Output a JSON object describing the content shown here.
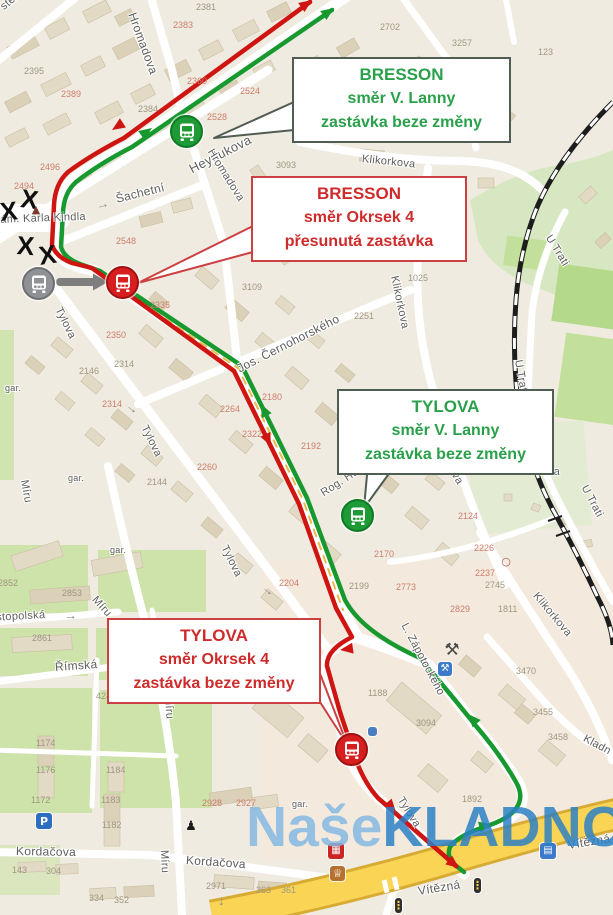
{
  "watermark": {
    "light": "Naše",
    "dark": "KLADNO"
  },
  "callouts": [
    {
      "title": "BRESSON",
      "line1": "směr V. Lanny",
      "line2": "zastávka beze změny",
      "variant": "green"
    },
    {
      "title": "BRESSON",
      "line1": "směr Okrsek 4",
      "line2": "přesunutá zastávka",
      "variant": "red"
    },
    {
      "title": "TYLOVA",
      "line1": "směr V. Lanny",
      "line2": "zastávka beze změny",
      "variant": "green"
    },
    {
      "title": "TYLOVA",
      "line1": "směr Okrsek 4",
      "line2": "zastávka beze změny",
      "variant": "red"
    }
  ],
  "colors": {
    "route_green": "#18992f",
    "route_red": "#cf1512",
    "callout_green_text": "#2aa04b",
    "callout_red_text": "#ce2b2b",
    "road_yellow": "#f9d455",
    "watermark_light": "#85b8e3",
    "watermark_dark": "#2a80c6",
    "stop_green": "#1e9a36",
    "stop_red": "#d81f1f",
    "stop_gray": "#8f9194"
  },
  "map": {
    "street_labels": [
      {
        "t": "sterova",
        "x": 2,
        "y": 2,
        "r": -40
      },
      {
        "t": "Heydukova",
        "x": 190,
        "y": 162,
        "r": -27,
        "s": 13
      },
      {
        "t": "Hromadova",
        "x": 132,
        "y": 6,
        "r": 70,
        "s": 12
      },
      {
        "t": "Hromadova",
        "x": 210,
        "y": 144,
        "r": 58
      },
      {
        "t": "Šachetní",
        "x": 116,
        "y": 192,
        "r": -14,
        "s": 12
      },
      {
        "t": "nám. Karla Kindla",
        "x": -6,
        "y": 214,
        "r": -2
      },
      {
        "t": "Klikorkova",
        "x": 362,
        "y": 153,
        "r": 6
      },
      {
        "t": "Klikorkova",
        "x": 394,
        "y": 270,
        "r": 78
      },
      {
        "t": "Klikorkova",
        "x": 432,
        "y": 432,
        "r": 58
      },
      {
        "t": "Klikorkova",
        "x": 535,
        "y": 588,
        "r": 50
      },
      {
        "t": "Jos. Černohorského",
        "x": 238,
        "y": 362,
        "r": -27,
        "s": 12
      },
      {
        "t": "Tylova",
        "x": 58,
        "y": 302,
        "r": 64
      },
      {
        "t": "Tylova",
        "x": 144,
        "y": 420,
        "r": 64
      },
      {
        "t": "Tylova",
        "x": 224,
        "y": 540,
        "r": 64
      },
      {
        "t": "Tylova",
        "x": 400,
        "y": 792,
        "r": 58
      },
      {
        "t": "Míru",
        "x": 24,
        "y": 474,
        "r": 80
      },
      {
        "t": "Míru",
        "x": 94,
        "y": 592,
        "r": 48
      },
      {
        "t": "Míru",
        "x": 168,
        "y": 690,
        "r": 86
      },
      {
        "t": "Míru",
        "x": 164,
        "y": 844,
        "r": 88
      },
      {
        "t": "Sevastopolská",
        "x": -30,
        "y": 613,
        "r": -3
      },
      {
        "t": "Římská",
        "x": 55,
        "y": 660,
        "r": -4,
        "s": 12
      },
      {
        "t": "Kordačova",
        "x": 16,
        "y": 844,
        "r": 1,
        "s": 12
      },
      {
        "t": "Kordačova",
        "x": 186,
        "y": 853,
        "r": 4,
        "s": 12
      },
      {
        "t": "L. Zápotockého",
        "x": 404,
        "y": 618,
        "r": 62
      },
      {
        "t": "U Trati",
        "x": 548,
        "y": 230,
        "r": 58
      },
      {
        "t": "U Trati",
        "x": 518,
        "y": 354,
        "r": 80
      },
      {
        "t": "U Trati",
        "x": 584,
        "y": 480,
        "r": 62
      },
      {
        "t": "Vítězná",
        "x": 418,
        "y": 884,
        "r": -9,
        "s": 12
      },
      {
        "t": "Vítězná",
        "x": 568,
        "y": 838,
        "r": -9,
        "s": 12
      },
      {
        "t": "zahr. osada",
        "x": 500,
        "y": 464,
        "r": 2
      },
      {
        "t": "Kladn",
        "x": 584,
        "y": 732,
        "r": 28
      },
      {
        "t": "Rog. Hol.",
        "x": 322,
        "y": 488,
        "r": -33
      },
      {
        "t": "gar.",
        "x": 5,
        "y": 383,
        "s": 9
      },
      {
        "t": "gar.",
        "x": 68,
        "y": 473,
        "s": 9
      },
      {
        "t": "gar.",
        "x": 110,
        "y": 545,
        "s": 9
      },
      {
        "t": "gar.",
        "x": 292,
        "y": 799,
        "s": 9
      }
    ],
    "house_numbers": [
      {
        "t": "2395",
        "x": 24,
        "y": 66
      },
      {
        "t": "2389",
        "x": 61,
        "y": 89,
        "c": "p"
      },
      {
        "t": "2381",
        "x": 196,
        "y": 2
      },
      {
        "t": "2383",
        "x": 173,
        "y": 20,
        "c": "p"
      },
      {
        "t": "2384",
        "x": 138,
        "y": 104
      },
      {
        "t": "2360",
        "x": 187,
        "y": 76,
        "c": "p"
      },
      {
        "t": "2524",
        "x": 240,
        "y": 86,
        "c": "p"
      },
      {
        "t": "2528",
        "x": 207,
        "y": 112,
        "c": "p"
      },
      {
        "t": "3093",
        "x": 276,
        "y": 160
      },
      {
        "t": "2702",
        "x": 380,
        "y": 22
      },
      {
        "t": "3257",
        "x": 452,
        "y": 38
      },
      {
        "t": "889",
        "x": 484,
        "y": 57
      },
      {
        "t": "123",
        "x": 538,
        "y": 47
      },
      {
        "t": "3255",
        "x": 484,
        "y": 123
      },
      {
        "t": "2496",
        "x": 40,
        "y": 162,
        "c": "p"
      },
      {
        "t": "2494",
        "x": 14,
        "y": 181,
        "c": "p"
      },
      {
        "t": "2548",
        "x": 116,
        "y": 236,
        "c": "p"
      },
      {
        "t": "2335",
        "x": 150,
        "y": 300,
        "c": "p"
      },
      {
        "t": "3109",
        "x": 242,
        "y": 282
      },
      {
        "t": "2350",
        "x": 106,
        "y": 330,
        "c": "p"
      },
      {
        "t": "2146",
        "x": 79,
        "y": 366
      },
      {
        "t": "2314",
        "x": 114,
        "y": 359
      },
      {
        "t": "2314",
        "x": 102,
        "y": 399,
        "c": "p"
      },
      {
        "t": "2264",
        "x": 220,
        "y": 404,
        "c": "p"
      },
      {
        "t": "2260",
        "x": 197,
        "y": 462,
        "c": "p"
      },
      {
        "t": "2144",
        "x": 147,
        "y": 477
      },
      {
        "t": "2251",
        "x": 354,
        "y": 311
      },
      {
        "t": "1025",
        "x": 408,
        "y": 273
      },
      {
        "t": "2180",
        "x": 262,
        "y": 392,
        "c": "p"
      },
      {
        "t": "2322",
        "x": 242,
        "y": 429,
        "c": "p"
      },
      {
        "t": "2192",
        "x": 301,
        "y": 441,
        "c": "p"
      },
      {
        "t": "2170",
        "x": 374,
        "y": 549,
        "c": "p"
      },
      {
        "t": "2199",
        "x": 349,
        "y": 581
      },
      {
        "t": "2773",
        "x": 396,
        "y": 582,
        "c": "p"
      },
      {
        "t": "2204",
        "x": 279,
        "y": 578,
        "c": "p"
      },
      {
        "t": "2124",
        "x": 458,
        "y": 511,
        "c": "p"
      },
      {
        "t": "2226",
        "x": 474,
        "y": 543,
        "c": "p"
      },
      {
        "t": "2237",
        "x": 475,
        "y": 568,
        "c": "p"
      },
      {
        "t": "2745",
        "x": 485,
        "y": 580
      },
      {
        "t": "2829",
        "x": 450,
        "y": 604,
        "c": "p"
      },
      {
        "t": "1811",
        "x": 498,
        "y": 604
      },
      {
        "t": "3470",
        "x": 516,
        "y": 666
      },
      {
        "t": "3455",
        "x": 533,
        "y": 707
      },
      {
        "t": "3458",
        "x": 548,
        "y": 732
      },
      {
        "t": "3094",
        "x": 416,
        "y": 718
      },
      {
        "t": "1892",
        "x": 462,
        "y": 794
      },
      {
        "t": "1188",
        "x": 368,
        "y": 688
      },
      {
        "t": "233",
        "x": 303,
        "y": 671
      },
      {
        "t": "2853",
        "x": 62,
        "y": 588
      },
      {
        "t": "2852",
        "x": -2,
        "y": 578
      },
      {
        "t": "2861",
        "x": 32,
        "y": 633
      },
      {
        "t": "424",
        "x": 96,
        "y": 691
      },
      {
        "t": "495",
        "x": 126,
        "y": 693
      },
      {
        "t": "1174",
        "x": 36,
        "y": 738
      },
      {
        "t": "1176",
        "x": 36,
        "y": 765
      },
      {
        "t": "1184",
        "x": 106,
        "y": 765
      },
      {
        "t": "1172",
        "x": 31,
        "y": 795
      },
      {
        "t": "1183",
        "x": 101,
        "y": 795
      },
      {
        "t": "1182",
        "x": 102,
        "y": 820
      },
      {
        "t": "143",
        "x": 12,
        "y": 865
      },
      {
        "t": "304",
        "x": 46,
        "y": 866
      },
      {
        "t": "334",
        "x": 89,
        "y": 893
      },
      {
        "t": "352",
        "x": 114,
        "y": 895
      },
      {
        "t": "2928",
        "x": 202,
        "y": 798,
        "c": "p"
      },
      {
        "t": "2927",
        "x": 236,
        "y": 798,
        "c": "p"
      },
      {
        "t": "2971",
        "x": 206,
        "y": 881
      },
      {
        "t": "363",
        "x": 256,
        "y": 885
      },
      {
        "t": "361",
        "x": 281,
        "y": 885
      }
    ],
    "x_marks": [
      {
        "t": "X",
        "x": 21,
        "y": 185,
        "r": 8
      },
      {
        "t": "X",
        "x": 0,
        "y": 199,
        "r": -6
      },
      {
        "t": "X",
        "x": 17,
        "y": 232,
        "r": 4
      },
      {
        "t": "X",
        "x": 39,
        "y": 243,
        "r": -8
      }
    ],
    "road_arrows": [
      {
        "t": "→",
        "x": 96,
        "y": 198,
        "r": -14
      },
      {
        "t": "→",
        "x": 128,
        "y": 396,
        "r": 40
      },
      {
        "t": "→",
        "x": 264,
        "y": 578,
        "r": 40
      },
      {
        "t": "→",
        "x": 64,
        "y": 608,
        "r": -3
      },
      {
        "t": "↓",
        "x": 218,
        "y": 893
      }
    ],
    "poi_icons": [
      {
        "name": "parking-icon",
        "g": "P",
        "x": 36,
        "y": 813,
        "bg": "#2e6ec0"
      },
      {
        "name": "hotel-icon",
        "g": "▤",
        "x": 540,
        "y": 843,
        "bg": "#3d7ac9",
        "s": 10
      },
      {
        "name": "fire-station-icon",
        "g": "▦",
        "x": 328,
        "y": 843,
        "bg": "#cc2525",
        "s": 10
      },
      {
        "name": "shop-icon",
        "g": "♕",
        "x": 330,
        "y": 866,
        "bg": "#b5722f",
        "s": 11,
        "w": 15,
        "h": 15
      },
      {
        "name": "workshop-icon",
        "g": "⚒",
        "x": 442,
        "y": 640,
        "fg": "#4a4a4a",
        "s": 17,
        "w": 20,
        "h": 20
      },
      {
        "name": "tool-icon",
        "g": "⚒",
        "x": 438,
        "y": 662,
        "bg": "#3d7ac9",
        "s": 10,
        "w": 14,
        "h": 14
      },
      {
        "name": "school-icon",
        "g": "",
        "x": 368,
        "y": 727,
        "bg": "#4a7dc0",
        "w": 9,
        "h": 9
      },
      {
        "name": "traffic-light-icon",
        "g": "⋮",
        "x": 474,
        "y": 878,
        "bg": "#2f2f2f",
        "fg": "#ffd34d",
        "w": 7,
        "h": 15,
        "s": 11
      },
      {
        "name": "traffic-light-icon",
        "g": "⋮",
        "x": 395,
        "y": 898,
        "bg": "#2f2f2f",
        "fg": "#ffd34d",
        "w": 7,
        "h": 15,
        "s": 11
      },
      {
        "name": "monument-icon",
        "g": "▲",
        "x": 30,
        "y": 202,
        "fg": "#7a3b2e",
        "s": 11,
        "w": 12,
        "h": 14
      },
      {
        "name": "statue-icon",
        "g": "♟",
        "x": 184,
        "y": 818,
        "fg": "#1a1a1a",
        "s": 13,
        "w": 14,
        "h": 16
      },
      {
        "name": "railway-circle-marker",
        "g": "○",
        "x": 500,
        "y": 555,
        "fg": "#b05050",
        "s": 11,
        "w": 12,
        "h": 12
      }
    ],
    "bus_stops": [
      {
        "name": "bresson-smer-v-lanny",
        "variant": "green",
        "x": 186,
        "y": 131
      },
      {
        "name": "bresson-smer-okrsek4-new",
        "variant": "red",
        "x": 122,
        "y": 282
      },
      {
        "name": "bresson-smer-okrsek4-old",
        "variant": "gray",
        "x": 38,
        "y": 283
      },
      {
        "name": "tylova-smer-v-lanny",
        "variant": "green",
        "x": 357,
        "y": 515
      },
      {
        "name": "tylova-smer-okrsek4",
        "variant": "red",
        "x": 351,
        "y": 749
      }
    ]
  }
}
